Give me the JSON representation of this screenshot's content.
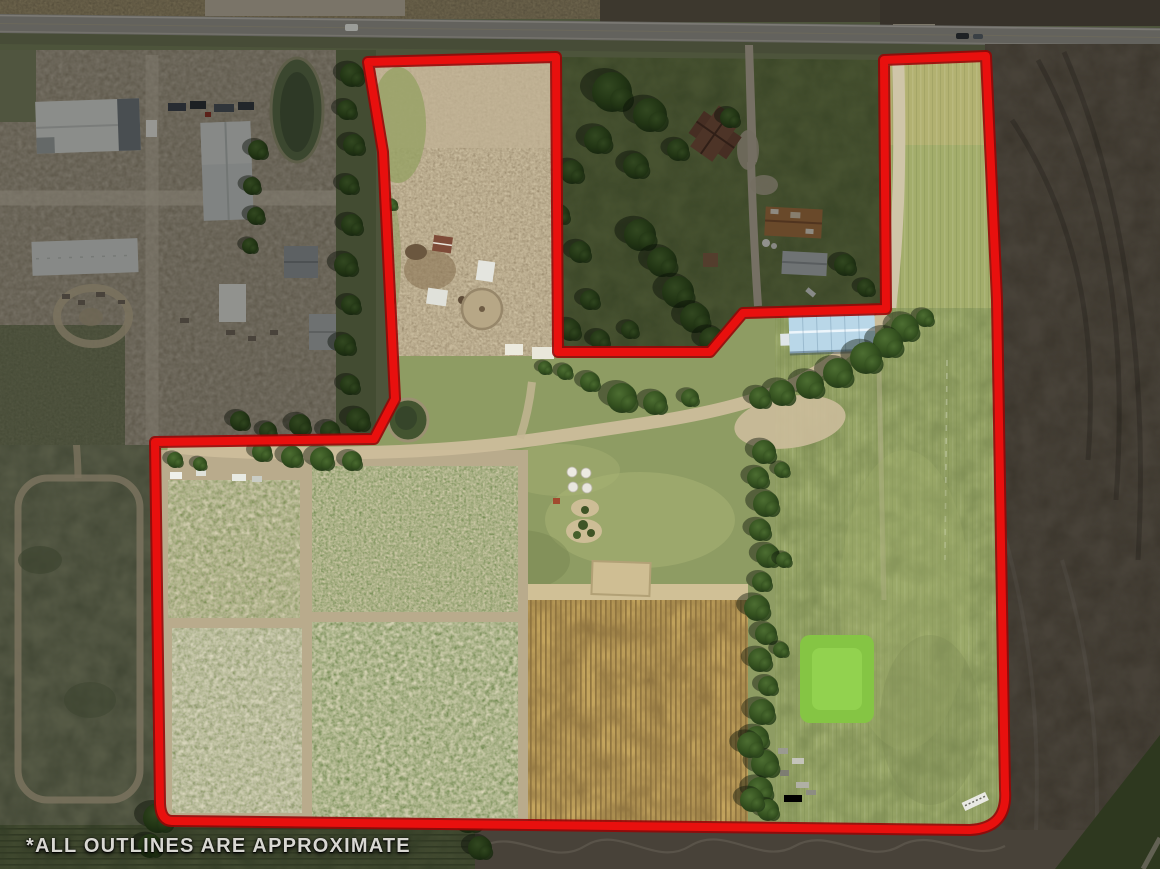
{
  "annotation": {
    "disclaimer": "*ALL OUTLINES ARE APPROXIMATE",
    "outline_color": "#e8100e",
    "outline_underlay_color": "#960707",
    "outside_dim_opacity": "0.34"
  },
  "scene": {
    "type": "aerial-property-photo",
    "features": [
      "county-road-north",
      "industrial-yard-west",
      "warehouse-buildings",
      "storage-pond",
      "circular-dirt-track",
      "excluded-farmstead",
      "farm-house",
      "rusty-roof-barn",
      "gray-machine-shed",
      "blue-roof-building",
      "dirt-paddock-north-parcel",
      "round-pen",
      "small-sheds",
      "farm-pond",
      "garden-plots",
      "corn-stubble-plot",
      "bright-green-plot",
      "windbreak-tree-row",
      "riding-arena",
      "white-grain-bins",
      "pasture",
      "east-access-strip",
      "plowed-field-east",
      "dirt-track"
    ]
  }
}
